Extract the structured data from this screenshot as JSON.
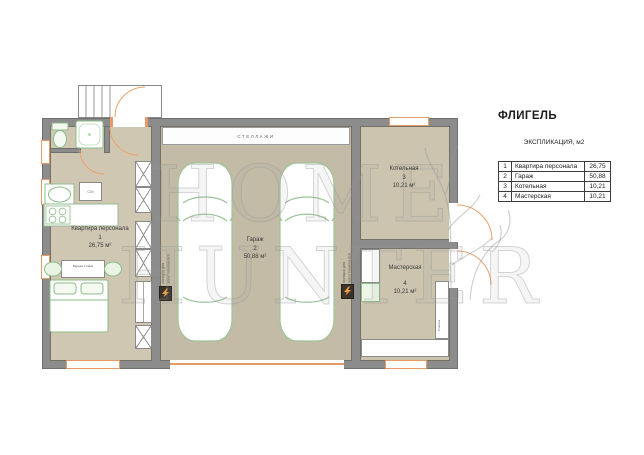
{
  "page_title": "ФЛИГЕЛЬ",
  "legend": {
    "title": "ЭКСПЛИКАЦИЯ, м2",
    "rows": [
      {
        "num": "1",
        "name": "Квартира персонала",
        "area": "26,75"
      },
      {
        "num": "2",
        "name": "Гараж",
        "area": "50,88"
      },
      {
        "num": "3",
        "name": "Котельная",
        "area": "10,21"
      },
      {
        "num": "4",
        "name": "Мастерская",
        "area": "10,21"
      }
    ]
  },
  "rooms": {
    "apartment": {
      "name": "Квартира персонала",
      "num": "1",
      "area": "26,75 м²"
    },
    "garage": {
      "name": "Гараж",
      "num": "2",
      "area": "50,88 м²"
    },
    "boiler": {
      "name": "Котельная",
      "num": "3",
      "area": "10,21 м²"
    },
    "workshop": {
      "name": "Мастерская",
      "num": "4",
      "area": "10,21 м²"
    }
  },
  "plan_labels": {
    "shelving": "СТЕЛЛАЖИ",
    "ev_charging": "ЗАРЯДКА ДЛЯ ЭЛЕКТРОМОБИЛЕЙ",
    "bar_counter": "Барная стойка",
    "washer": "СМ",
    "meter": "Счетчик"
  },
  "watermark": {
    "line1": "HOME",
    "line2": "HUNTER"
  },
  "colors": {
    "wall": "#8c8c8c",
    "apartment_floor": "#cfc7b2",
    "garage_floor": "#c3bba5",
    "utility_floor": "#ccc4ae",
    "openings": "#e89a64",
    "furniture_green": "#8bbd88"
  }
}
